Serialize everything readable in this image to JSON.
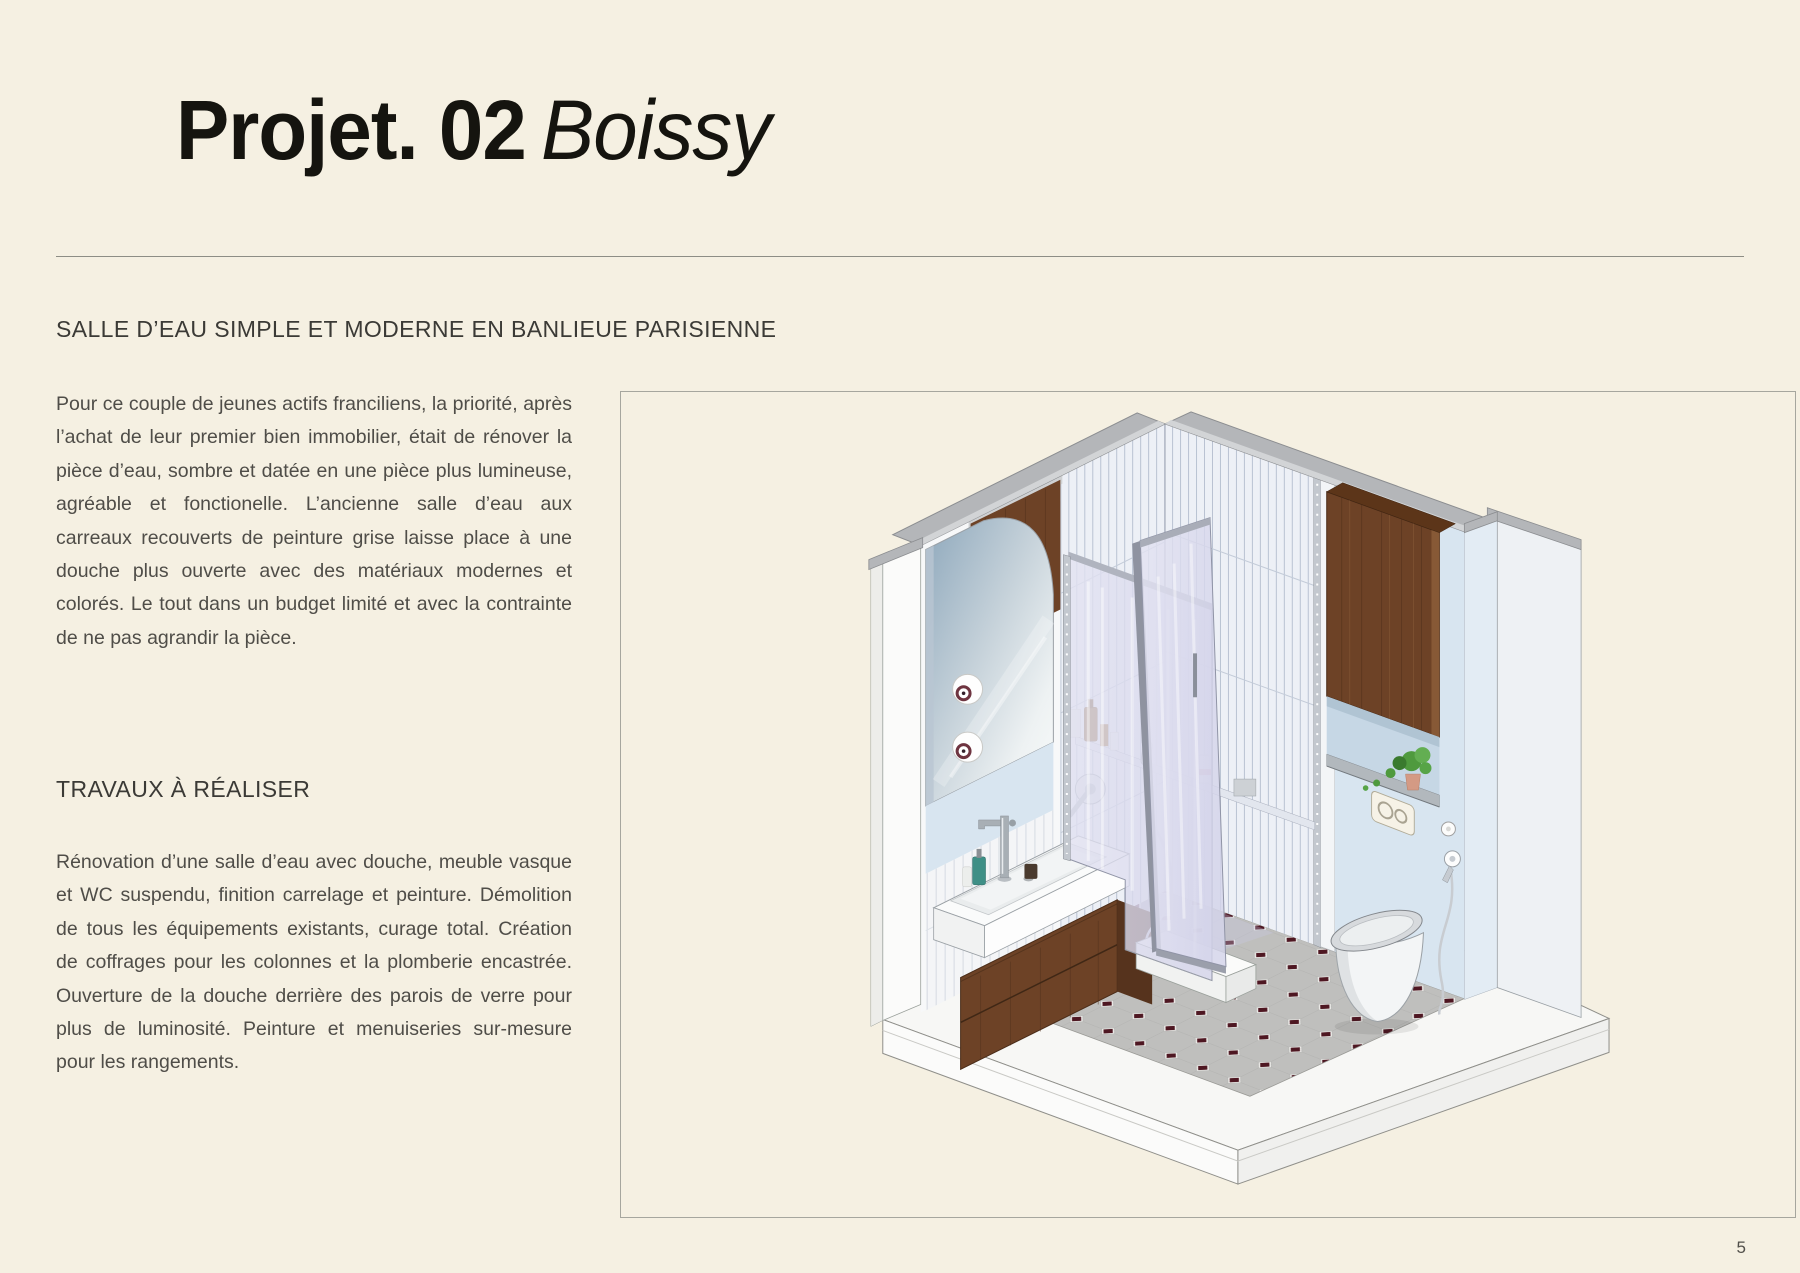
{
  "document": {
    "background": "#f5f0e2",
    "title": {
      "main": "Projet. 02",
      "accent": "Boissy"
    },
    "intro": {
      "heading": "SALLE D’EAU SIMPLE ET MODERNE EN BANLIEUE PARISIENNE",
      "body": "Pour ce couple de jeunes actifs franciliens, la priorité, après l’achat de leur premier bien immobilier, était de rénover la pièce d’eau, sombre et datée en une pièce plus lumineuse, agréable et fonctionelle. L’ancienne salle d’eau aux carreaux recouverts de peinture grise laisse place à une douche plus ouverte avec des matériaux modernes et colorés. Le tout dans un budget limité et avec la contrainte de ne pas agrandir la pièce."
    },
    "works": {
      "heading": "TRAVAUX À RÉALISER",
      "body": "Rénovation d’une salle d’eau avec douche, meuble vasque et WC suspendu, finition carrelage et peinture. Démolition de tous les équipements existants, curage total. Création de coffrages pour les colonnes et la plomberie encastrée. Ouverture de la douche derrière des parois de verre pour plus de luminosité. Peinture et menuiseries sur-mesure pour les rangements."
    },
    "page_number": "5",
    "illustration": {
      "name": "axonometrie-salle-d-eau",
      "colors": {
        "cut_gray": "#b4b6b9",
        "cut_gray_light": "#d2d4d6",
        "wall_white": "#fbfbfa",
        "wall_shade": "#ededea",
        "tile_fill": "#edf0f6",
        "paint_blue": "#d8e5f0",
        "niche_blue": "#c6d7e5",
        "wood": "#6d4226",
        "wood_dark": "#50301b",
        "wood_light": "#8a5c38",
        "glass_edge": "#9094a6",
        "chrome": "#c3c8cf",
        "floor_tile": "#bfbfbd",
        "floor_grout": "#efefec",
        "floor_dot": "#4e1722",
        "platform": "#f7f7f5",
        "ceramic": "#f3f5f6",
        "plant": "#4f9a3e",
        "pot": "#d49a84"
      }
    }
  }
}
